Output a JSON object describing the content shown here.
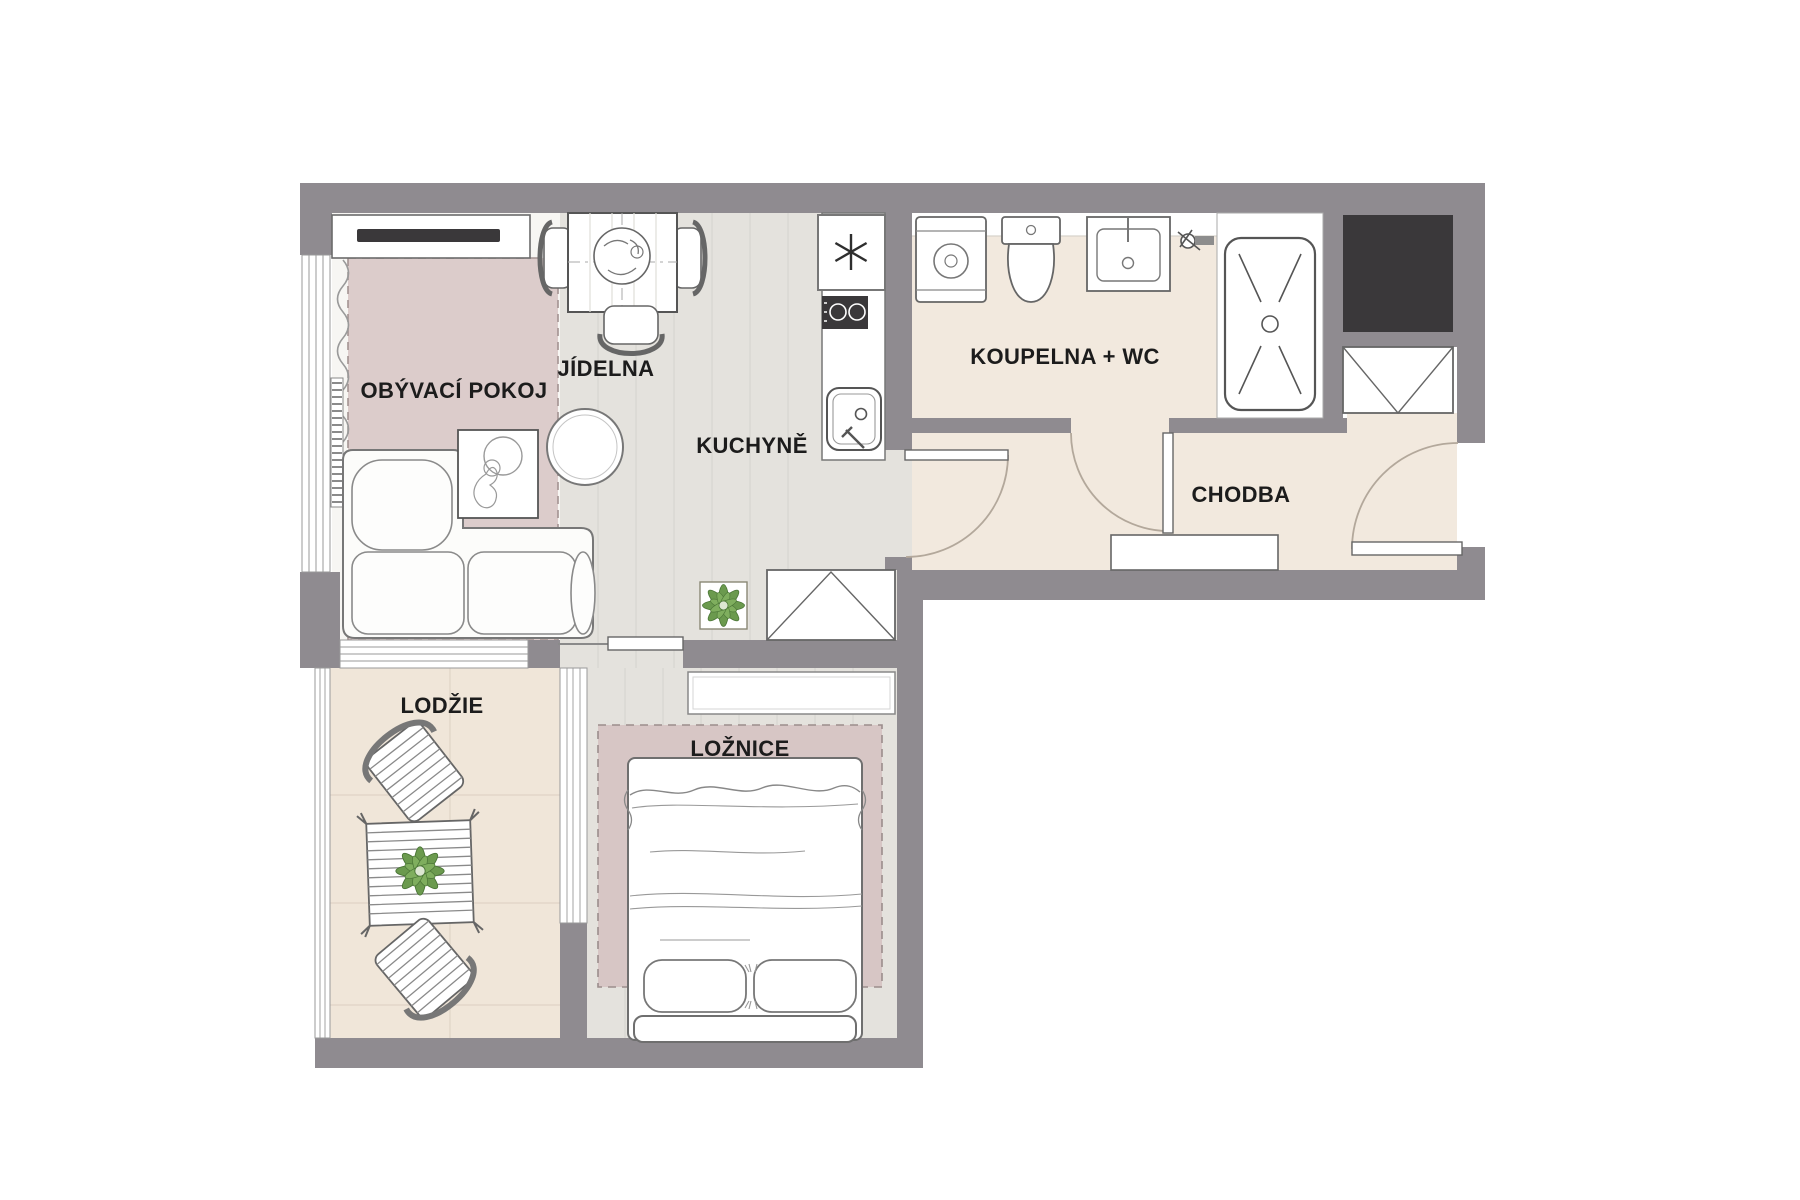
{
  "title": "Apartment floor plan",
  "rooms": {
    "living": {
      "label": "OBÝVACÍ POKOJ"
    },
    "dining": {
      "label": "JÍDELNA"
    },
    "kitchen": {
      "label": "KUCHYNĚ"
    },
    "bathroom": {
      "label": "KOUPELNA + WC"
    },
    "hallway": {
      "label": "CHODBA"
    },
    "loggia": {
      "label": "LODŽIE"
    },
    "bedroom": {
      "label": "LOŽNICE"
    }
  },
  "symbols": [
    "tv-icon",
    "sideboard-icon",
    "sofa-icon",
    "coffee-table-icon",
    "round-side-table-icon",
    "dining-table-icon",
    "chair-icon",
    "plant-icon",
    "fridge-snowflake-icon",
    "cooktop-icon",
    "kitchen-sink-icon",
    "washing-machine-icon",
    "toilet-icon",
    "washbasin-icon",
    "faucet-icon",
    "shower-icon",
    "shaft-icon",
    "wardrobe-icon",
    "sliding-door-icon",
    "door-swing-icon",
    "entry-door-icon",
    "bed-icon",
    "pillow-icon",
    "headboard-icon",
    "shelf-icon",
    "bench-icon",
    "lounge-chair-icon",
    "patio-table-icon",
    "radiator-icon",
    "curtain-icon",
    "window-icon"
  ],
  "colors": {
    "wall": "#8f8b90",
    "dark": "#3a383a",
    "beige": "#f2e9de",
    "loggia_floor": "#f0e6d9",
    "plank": "#e4e2dd",
    "living_floor": "#f7f6f3",
    "rug1": "#dccccb",
    "rug2": "#d7c6c5",
    "arc": "#b3a89b",
    "stroke": "#6e6e6e",
    "plant": "#6b9a4e"
  }
}
